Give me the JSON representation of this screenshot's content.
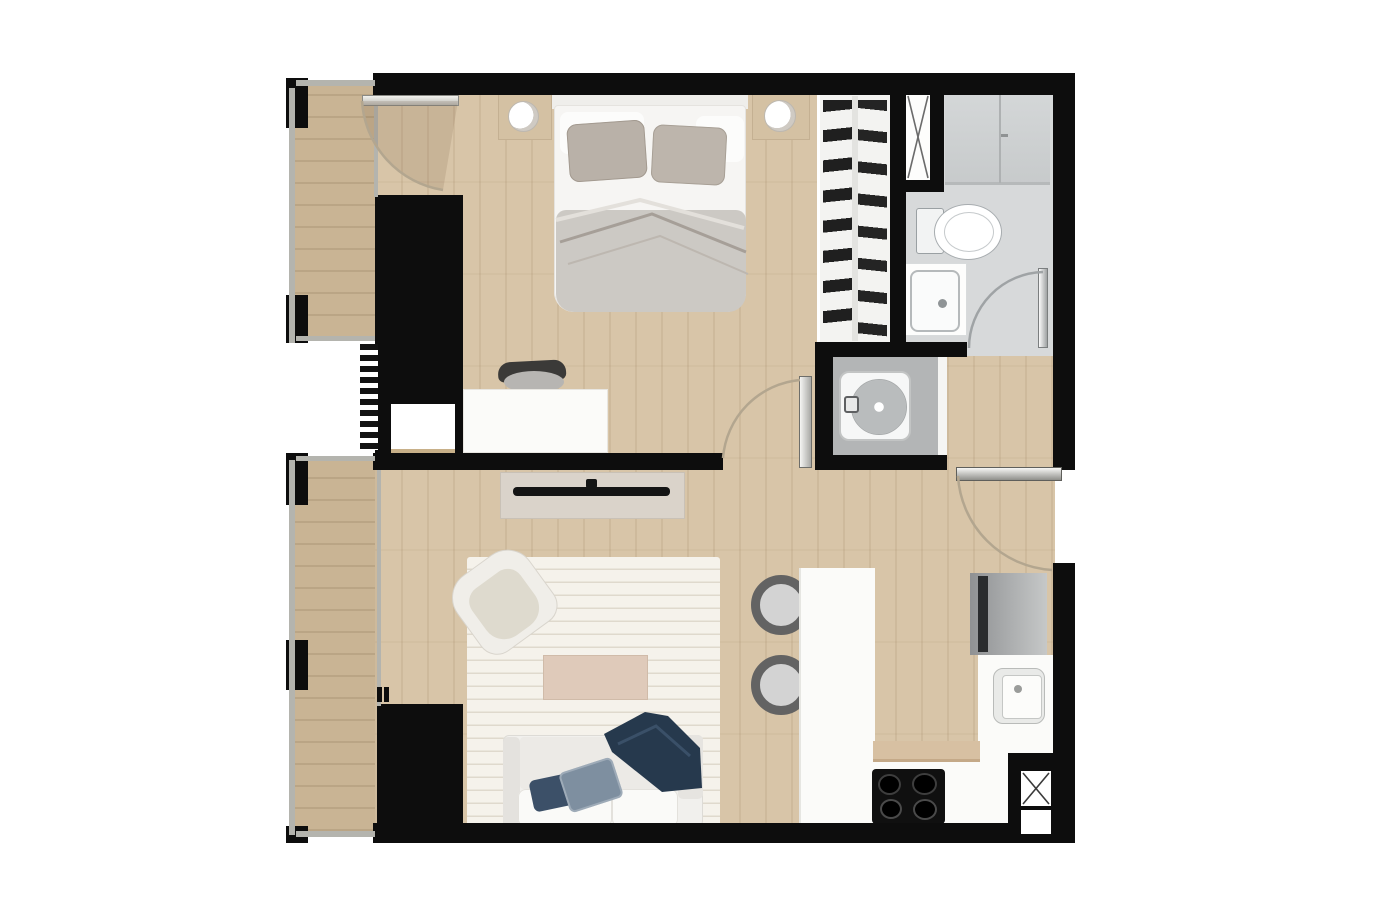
{
  "meta": {
    "title": "One-bedroom apartment floor plan (top-down 3D render)",
    "view": "floor-plan-top-view",
    "text_labels": []
  },
  "colors": {
    "wall": "#0d0d0d",
    "glazing": "#b4b4ae",
    "wood": "#d8c5a8",
    "wood-balcony": "#c9b494",
    "bath-floor": "#d7d9da",
    "niche-floor": "#b3b5b6",
    "rug": "#f5f2eb",
    "counter": "#fbfbf9",
    "duvet": "#ccc9c4",
    "pillow-taupe": "#b9b1a8",
    "navy-dark": "#26394d",
    "navy-pillow": "#3c5068",
    "bluegray-pillow": "#7e8fa0",
    "coffee-table": "#dfcaba",
    "tv-console": "#dad3ca",
    "tv-black": "#141414",
    "fridge-dark": "#8f9193",
    "fridge-light": "#c6c8c8",
    "stove": "#101010",
    "board": "#d7c0a2",
    "arc-wood": "#b3a68f",
    "arc-gray": "#9fa3a5"
  },
  "rooms": [
    {
      "name": "bedroom",
      "features": [
        "double-bed",
        "nightstands-with-lamps",
        "wardrobe-block",
        "desk",
        "desk-chair",
        "open-closet"
      ]
    },
    {
      "name": "living-room",
      "features": [
        "rug",
        "sofa",
        "armchair",
        "coffee-table",
        "tv-console"
      ]
    },
    {
      "name": "kitchen",
      "features": [
        "island-counter",
        "two-bar-stools",
        "fridge",
        "sink",
        "cooktop",
        "cutting-board"
      ]
    },
    {
      "name": "bathroom",
      "features": [
        "toilet",
        "vanity-sink",
        "storage-cabinet",
        "ventilation-shaft"
      ]
    },
    {
      "name": "laundry-niche",
      "features": [
        "washing-machine"
      ]
    },
    {
      "name": "hallway",
      "features": [
        "entry-door"
      ]
    },
    {
      "name": "balcony-bedroom",
      "features": [
        "glazed-facade"
      ]
    },
    {
      "name": "balcony-living",
      "features": [
        "glazed-facade",
        "sliding-door-marks"
      ]
    },
    {
      "name": "service-shafts",
      "features": [
        "x-cross-shaft-bathroom",
        "x-cross-shaft-kitchen"
      ]
    }
  ],
  "doors": [
    {
      "name": "balcony-to-bedroom-door",
      "swing": "into-bedroom"
    },
    {
      "name": "bedroom-door",
      "swing": "into-bedroom"
    },
    {
      "name": "bathroom-door",
      "swing": "into-bathroom"
    },
    {
      "name": "entry-door",
      "swing": "inward-from-right-wall"
    }
  ]
}
